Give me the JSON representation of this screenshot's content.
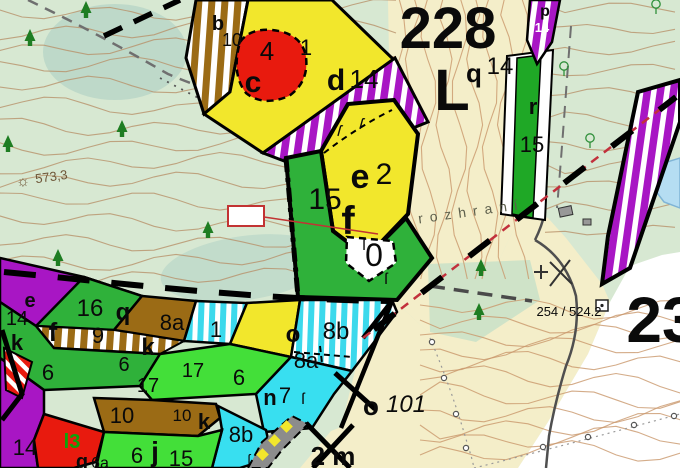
{
  "map_type": "forestry-stand-map",
  "colors": {
    "bg_green": "#d7e8d2",
    "bg_beige": "#f4eec9",
    "bg_white": "#ffffff",
    "stand_yellow": "#f2e72c",
    "stand_green": "#2fb13a",
    "stand_bright_green": "#43df39",
    "stand_magenta": "#a816c4",
    "stand_brown": "#9b6b15",
    "stand_cyan": "#38dff0",
    "stand_red": "#e81a0e",
    "lake_blue": "#b5ddf2",
    "contour_brown": "#c0976b",
    "boundary_black": "#000000",
    "boundary_red": "#c2303c",
    "plot_red": "#a01010"
  },
  "icons": {
    "trig_point": "☼",
    "section_mark": "ſ",
    "conifer_tree": "triangle-tree",
    "broadleaf_tree": "circle-tree",
    "building": "gray-square",
    "survey_square": "square-with-dot"
  },
  "labels": [
    {
      "n": "label-stand-b",
      "t": "b",
      "x": 218,
      "y": 30,
      "s": 20,
      "b": 1
    },
    {
      "n": "label-stand-b-age",
      "t": "10",
      "x": 232,
      "y": 46,
      "s": 18
    },
    {
      "n": "label-stand-4",
      "t": "4",
      "x": 267,
      "y": 60,
      "s": 26
    },
    {
      "n": "label-stand-c-age",
      "t": "1",
      "x": 306,
      "y": 55,
      "s": 22
    },
    {
      "n": "label-stand-c",
      "t": "c",
      "x": 253,
      "y": 92,
      "s": 30,
      "b": 1
    },
    {
      "n": "label-stand-d",
      "t": "d",
      "x": 336,
      "y": 90,
      "s": 30,
      "b": 1
    },
    {
      "n": "label-stand-d-age",
      "t": "14",
      "x": 364,
      "y": 88,
      "s": 26
    },
    {
      "n": "label-compartment-number",
      "t": "228",
      "x": 448,
      "y": 48,
      "s": 58,
      "b": 1
    },
    {
      "n": "label-compartment-letter",
      "t": "L",
      "x": 452,
      "y": 110,
      "s": 58,
      "b": 1
    },
    {
      "n": "label-stand-q",
      "t": "q",
      "x": 474,
      "y": 82,
      "s": 26,
      "b": 1
    },
    {
      "n": "label-stand-q-age",
      "t": "14",
      "x": 500,
      "y": 74,
      "s": 24
    },
    {
      "n": "label-stand-p",
      "t": "p",
      "x": 545,
      "y": 16,
      "s": 16,
      "b": 1
    },
    {
      "n": "label-stand-p-age",
      "t": "14",
      "x": 542,
      "y": 32,
      "s": 13,
      "c": "#ffffff",
      "b": 1
    },
    {
      "n": "label-stand-r",
      "t": "r",
      "x": 533,
      "y": 114,
      "s": 22,
      "b": 1
    },
    {
      "n": "label-stand-r-age",
      "t": "15",
      "x": 532,
      "y": 152,
      "s": 22
    },
    {
      "n": "label-stand-e2",
      "t": "e",
      "x": 360,
      "y": 188,
      "s": 34,
      "b": 1
    },
    {
      "n": "label-stand-e2-age",
      "t": "2",
      "x": 384,
      "y": 184,
      "s": 30
    },
    {
      "n": "label-stand-f-age",
      "t": "15",
      "x": 325,
      "y": 209,
      "s": 30
    },
    {
      "n": "label-stand-f",
      "t": "f",
      "x": 348,
      "y": 234,
      "s": 40,
      "b": 1
    },
    {
      "n": "label-stand-0",
      "t": "0",
      "x": 374,
      "y": 266,
      "s": 32
    },
    {
      "n": "label-plot-number",
      "t": "932",
      "x": 246,
      "y": 222,
      "s": 13,
      "b": 1,
      "c": "#a01010"
    },
    {
      "n": "label-elevation",
      "t": "573,3",
      "x": 52,
      "y": 181,
      "s": 13,
      "c": "#6e5638",
      "r": -8
    },
    {
      "n": "trig-point-icon",
      "t": "☼",
      "x": 23,
      "y": 186,
      "s": 15,
      "c": "#6e5638"
    },
    {
      "n": "label-boundary-text",
      "t": "rozhraní",
      "x": 472,
      "y": 216,
      "s": 14,
      "c": "#5d5f4c",
      "ls": 7,
      "r": -8
    },
    {
      "n": "label-survey-point",
      "t": "254 / 524.2",
      "x": 569,
      "y": 316,
      "s": 13
    },
    {
      "n": "label-adjacent-compartment",
      "t": "23",
      "x": 662,
      "y": 342,
      "s": 64,
      "b": 1
    },
    {
      "n": "label-stand-o101",
      "t": "o",
      "x": 371,
      "y": 415,
      "s": 26,
      "b": 1
    },
    {
      "n": "label-stand-o101-num",
      "t": "101",
      "x": 406,
      "y": 412,
      "s": 24,
      "i": 1
    },
    {
      "n": "label-stand-2m",
      "t": "2 m",
      "x": 333,
      "y": 465,
      "s": 26,
      "b": 1
    },
    {
      "n": "label-cl-e",
      "t": "e",
      "x": 30,
      "y": 307,
      "s": 20,
      "b": 1
    },
    {
      "n": "label-cl-e-age",
      "t": "14",
      "x": 17,
      "y": 325,
      "s": 20
    },
    {
      "n": "label-cl-f",
      "t": "f",
      "x": 53,
      "y": 341,
      "s": 26,
      "b": 1
    },
    {
      "n": "label-cl-f-age",
      "t": "16",
      "x": 90,
      "y": 316,
      "s": 24
    },
    {
      "n": "label-cl-q",
      "t": "q",
      "x": 123,
      "y": 320,
      "s": 24,
      "b": 1
    },
    {
      "n": "label-cl-9",
      "t": "9",
      "x": 98,
      "y": 343,
      "s": 22
    },
    {
      "n": "label-cl-k1",
      "t": "k",
      "x": 17,
      "y": 350,
      "s": 22,
      "b": 1
    },
    {
      "n": "label-cl-6a",
      "t": "6",
      "x": 48,
      "y": 380,
      "s": 22
    },
    {
      "n": "label-cl-6b",
      "t": "6",
      "x": 124,
      "y": 371,
      "s": 20
    },
    {
      "n": "label-cl-k2",
      "t": "k",
      "x": 148,
      "y": 355,
      "s": 24,
      "b": 1
    },
    {
      "n": "label-cl-8a1",
      "t": "8a",
      "x": 172,
      "y": 330,
      "s": 22
    },
    {
      "n": "label-cl-1",
      "t": "1",
      "x": 216,
      "y": 337,
      "s": 22
    },
    {
      "n": "label-cl-o",
      "t": "o",
      "x": 293,
      "y": 342,
      "s": 24,
      "b": 1
    },
    {
      "n": "label-cl-8b1",
      "t": "8b",
      "x": 336,
      "y": 339,
      "s": 24
    },
    {
      "n": "label-cl-8a2",
      "t": "8a",
      "x": 306,
      "y": 368,
      "s": 22
    },
    {
      "n": "label-cl-17a",
      "t": "17",
      "x": 148,
      "y": 392,
      "s": 20
    },
    {
      "n": "label-cl-17b",
      "t": "17",
      "x": 193,
      "y": 377,
      "s": 20
    },
    {
      "n": "label-cl-6c",
      "t": "6",
      "x": 239,
      "y": 385,
      "s": 22
    },
    {
      "n": "label-cl-10a",
      "t": "10",
      "x": 122,
      "y": 423,
      "s": 22
    },
    {
      "n": "label-cl-10b",
      "t": "10",
      "x": 182,
      "y": 421,
      "s": 17
    },
    {
      "n": "label-cl-k3",
      "t": "k",
      "x": 204,
      "y": 429,
      "s": 22,
      "b": 1
    },
    {
      "n": "label-cl-l3",
      "t": "l3",
      "x": 72,
      "y": 448,
      "s": 20,
      "b": 1,
      "c": "#0aa50a"
    },
    {
      "n": "label-cl-14b",
      "t": "14",
      "x": 25,
      "y": 455,
      "s": 22
    },
    {
      "n": "label-cl-6d",
      "t": "6",
      "x": 137,
      "y": 463,
      "s": 22
    },
    {
      "n": "label-cl-j",
      "t": "j",
      "x": 155,
      "y": 461,
      "s": 28,
      "b": 1
    },
    {
      "n": "label-cl-15",
      "t": "15",
      "x": 181,
      "y": 466,
      "s": 22
    },
    {
      "n": "label-cl-8b2",
      "t": "8b",
      "x": 241,
      "y": 442,
      "s": 22
    },
    {
      "n": "label-cl-n",
      "t": "n",
      "x": 270,
      "y": 405,
      "s": 22,
      "b": 1
    },
    {
      "n": "label-cl-n7",
      "t": "7",
      "x": 285,
      "y": 403,
      "s": 22
    },
    {
      "n": "label-cl-g",
      "t": "g",
      "x": 82,
      "y": 468,
      "s": 20,
      "b": 1
    },
    {
      "n": "label-cl-g6a",
      "t": "6a",
      "x": 100,
      "y": 468,
      "s": 16
    },
    {
      "n": "section-mark-1",
      "t": "ſ",
      "x": 338,
      "y": 136,
      "s": 16,
      "r": 15
    },
    {
      "n": "section-mark-2",
      "t": "ſ",
      "x": 360,
      "y": 129,
      "s": 16,
      "r": 15
    },
    {
      "n": "section-mark-3",
      "t": "ſ",
      "x": 364,
      "y": 250,
      "s": 16
    },
    {
      "n": "section-mark-4",
      "t": "ſ",
      "x": 386,
      "y": 284,
      "s": 16
    },
    {
      "n": "section-mark-5",
      "t": "ſ",
      "x": 303,
      "y": 404,
      "s": 16
    },
    {
      "n": "section-mark-6",
      "t": "ſ",
      "x": 249,
      "y": 464,
      "s": 14
    }
  ]
}
